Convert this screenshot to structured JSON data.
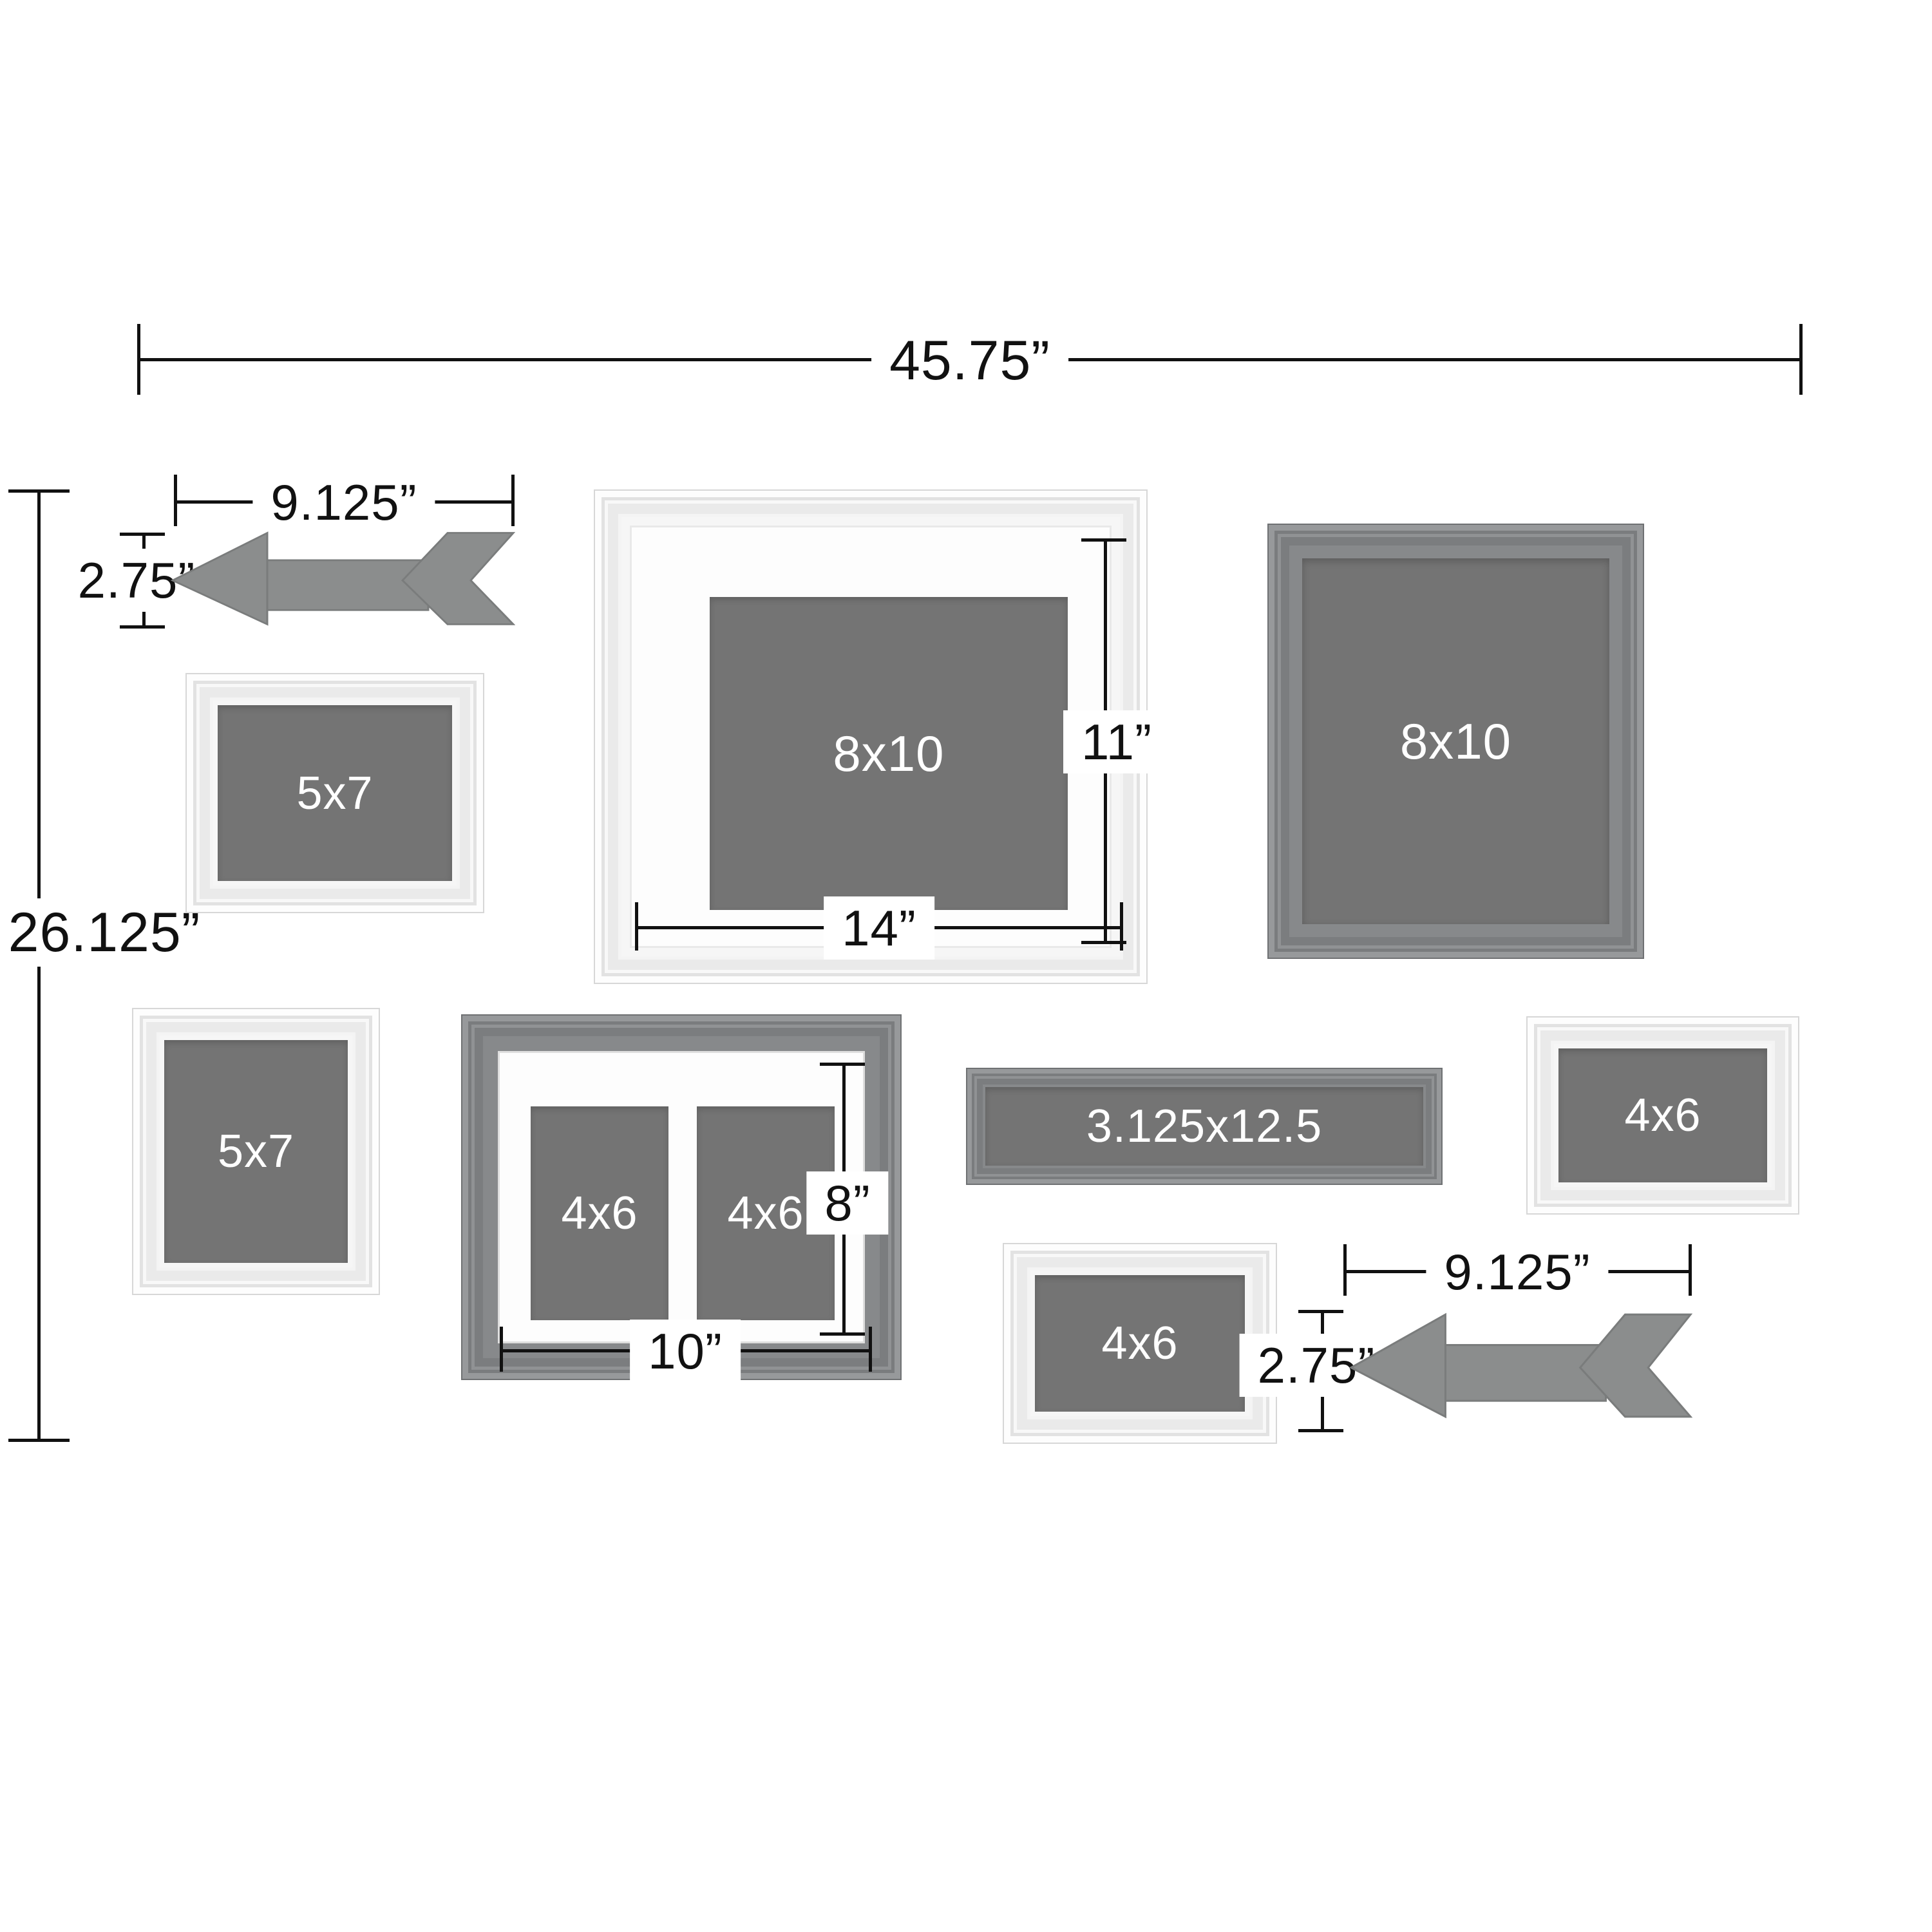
{
  "overall": {
    "width": "45.75”",
    "height": "26.125”"
  },
  "arrow_top_left": {
    "width": "9.125”",
    "height": "2.75”"
  },
  "arrow_bottom_right": {
    "width": "9.125”",
    "height": "2.75”"
  },
  "frames": {
    "top_5x7": {
      "label": "5x7"
    },
    "center_8x10": {
      "label": "8x10",
      "mat_height": "11”",
      "mat_width": "14”"
    },
    "right_8x10": {
      "label": "8x10"
    },
    "left_5x7": {
      "label": "5x7"
    },
    "collage_4x6": {
      "left_label": "4x6",
      "right_label": "4x6",
      "mat_height": "8”",
      "mat_width": "10”"
    },
    "ledge": {
      "label": "3.125x12.5"
    },
    "right_4x6": {
      "label": "4x6"
    },
    "bottom_4x6": {
      "label": "4x6"
    }
  },
  "colors": {
    "background": "#ffffff",
    "dimension": "#111111",
    "white_frame": "#f6f6f6",
    "gray_frame": "#87898b",
    "opening": "#747474",
    "mat": "#fdfdfd",
    "arrow": "#8b8d8d",
    "label_text": "#ffffff"
  }
}
